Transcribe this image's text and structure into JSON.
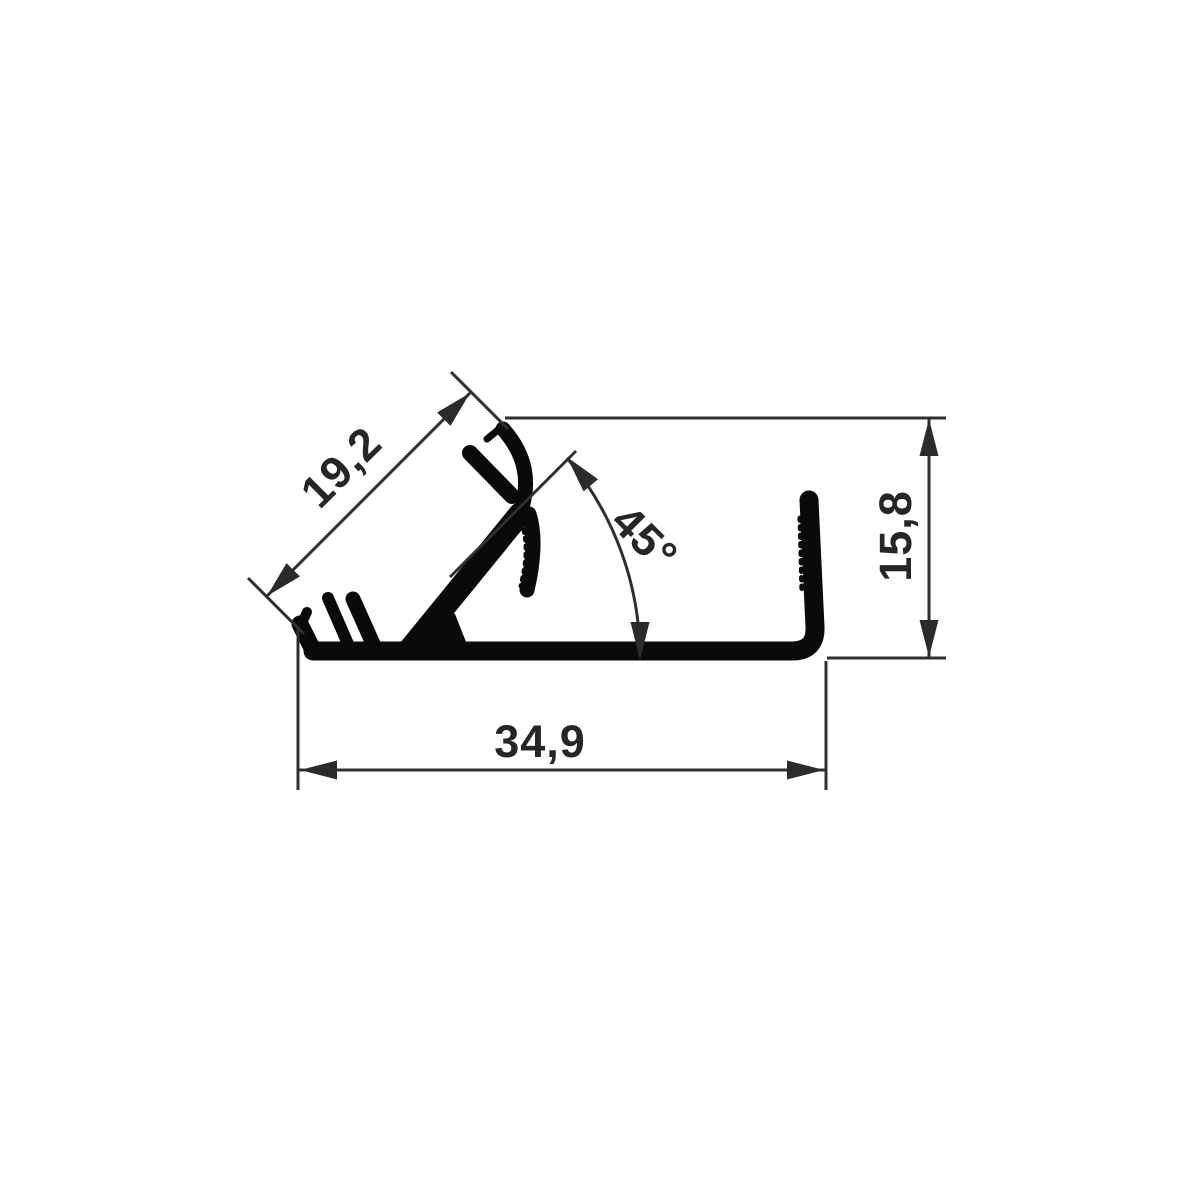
{
  "page": {
    "type": "technical-drawing",
    "subject": "extrusion-profile-cross-section",
    "background": "#ffffff"
  },
  "colors": {
    "profile": "#0a0a0a",
    "dimension_lines": "#2f2f2f",
    "text": "#262626"
  },
  "dimensions": {
    "arm_length": {
      "label": "19,2",
      "value": 19.2,
      "orientation": "aligned-45deg"
    },
    "angle": {
      "label": "45°",
      "value": 45,
      "orientation": "angular-arc"
    },
    "height": {
      "label": "15,8",
      "value": 15.8,
      "orientation": "vertical"
    },
    "width": {
      "label": "34,9",
      "value": 34.9,
      "orientation": "horizontal"
    }
  }
}
